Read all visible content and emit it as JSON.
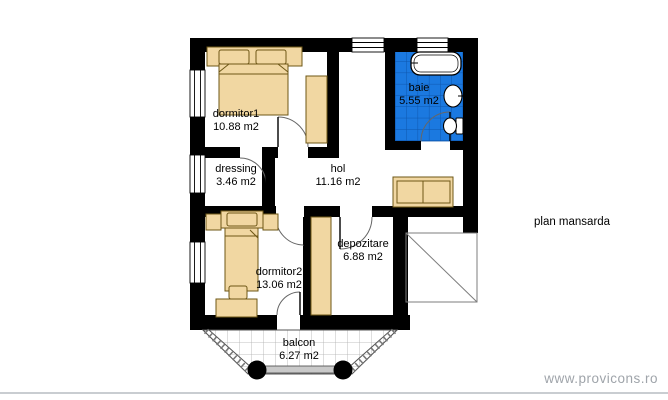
{
  "title": "plan mansarda",
  "watermark": "www.provicons.ro",
  "rooms": {
    "dormitor1": {
      "name": "dormitor1",
      "area": "10.88 m2"
    },
    "dressing": {
      "name": "dressing",
      "area": "3.46 m2"
    },
    "hol": {
      "name": "hol",
      "area": "11.16 m2"
    },
    "baie": {
      "name": "baie",
      "area": "5.55 m2"
    },
    "depozitare": {
      "name": "depozitare",
      "area": "6.88 m2"
    },
    "dormitor2": {
      "name": "dormitor2",
      "area": "13.06 m2"
    },
    "balcon": {
      "name": "balcon",
      "area": "6.27 m2"
    }
  },
  "colors": {
    "wall": "#000000",
    "furniture": "#f1d7a2",
    "furniture_outline": "#6e5716",
    "bath_tile": "#1b79e0",
    "bath_tile_grid": "#0d56ad",
    "watermark_gray": "#9fa4aa"
  },
  "fixtures": [
    "double-bed",
    "single-bed",
    "wardrobe",
    "sofa",
    "desk",
    "chair",
    "bathtub",
    "sink",
    "toilet",
    "balcony-columns",
    "roof-void"
  ]
}
